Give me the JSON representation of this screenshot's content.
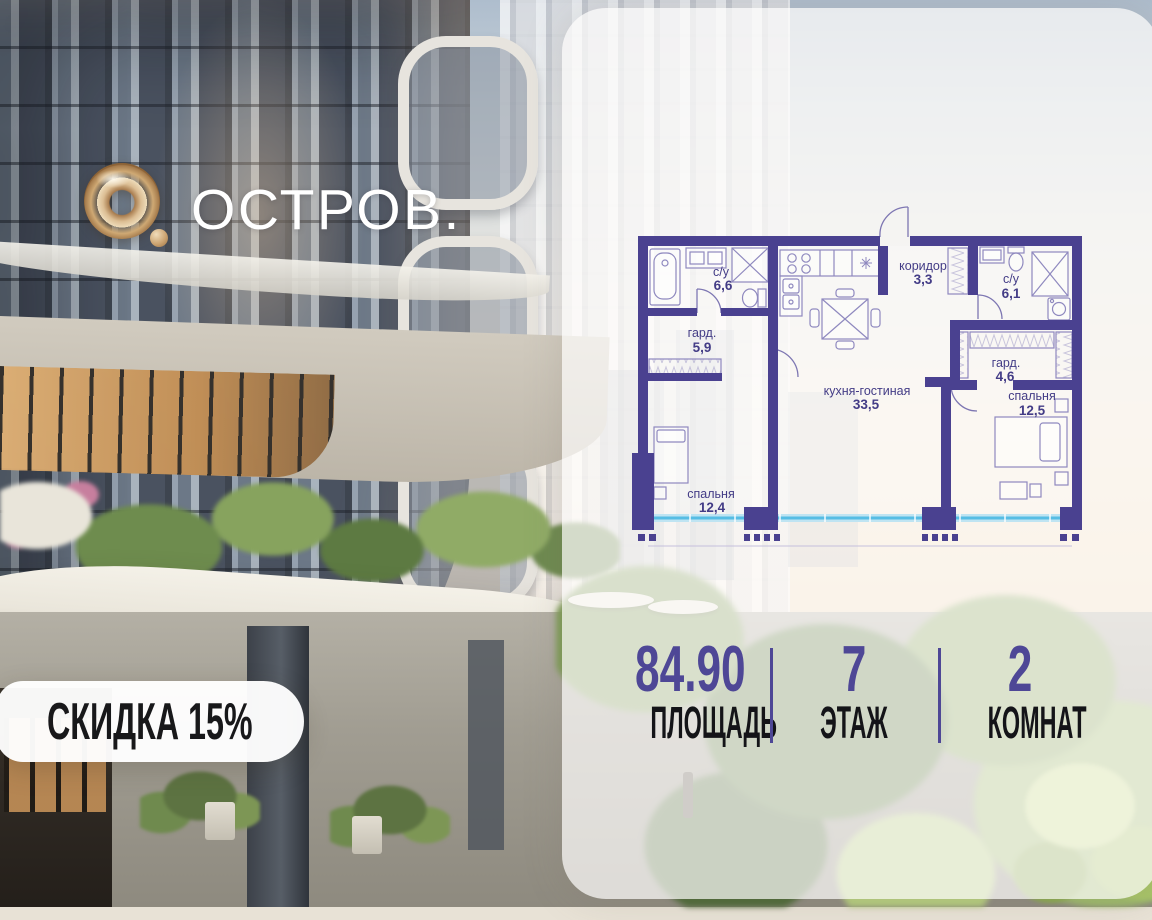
{
  "logo": {
    "brand": "ОСТРОВ.",
    "mark": "gold-ring-with-dot"
  },
  "discount_badge": {
    "label": "СКИДКА 15%"
  },
  "floor_plan": {
    "type": "apartment-floor-plan",
    "rooms": [
      {
        "name": "с/у",
        "area": "6,6"
      },
      {
        "name": "гард.",
        "area": "5,9"
      },
      {
        "name": "коридор",
        "area": "3,3"
      },
      {
        "name": "с/у",
        "area": "6,1"
      },
      {
        "name": "гард.",
        "area": "4,6"
      },
      {
        "name": "кухня-гостиная",
        "area": "33,5"
      },
      {
        "name": "спальня",
        "area": "12,5"
      },
      {
        "name": "спальня",
        "area": "12,4"
      }
    ]
  },
  "stats": {
    "items": [
      {
        "value": "84.90",
        "label": "ПЛОЩАДЬ"
      },
      {
        "value": "7",
        "label": "ЭТАЖ"
      },
      {
        "value": "2",
        "label": "КОМНАТ"
      }
    ]
  },
  "colors": {
    "wall_purple": "#4a4190",
    "accent_purple": "#4e4796",
    "window_blue": "#56bde4",
    "window_blue_light": "#bfe4f2",
    "logo_gold": "#cfa974",
    "badge_bg": "#ffffff",
    "badge_text": "#18181a",
    "panel_bg": "rgba(252,251,249,0.72)"
  }
}
